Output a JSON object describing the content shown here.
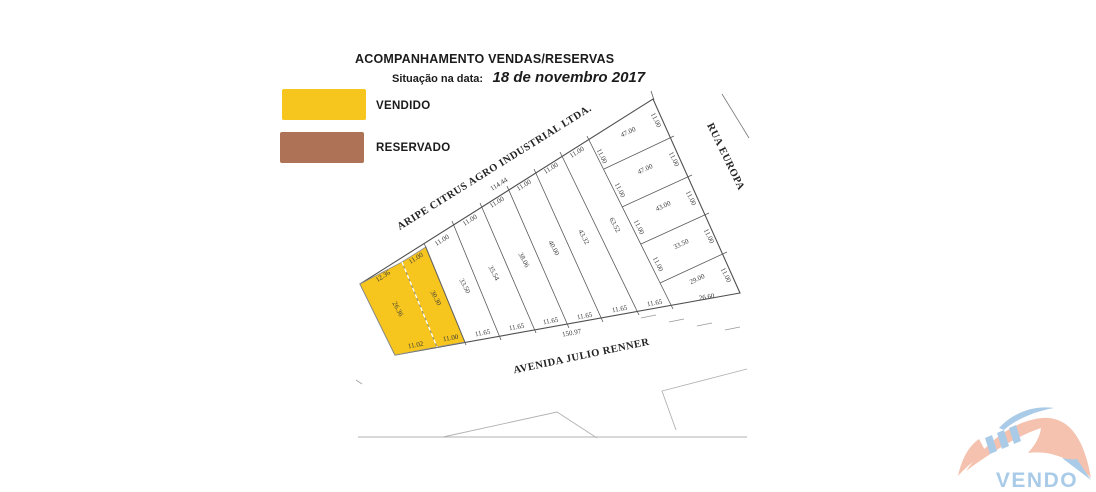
{
  "header": {
    "title": "ACOMPANHAMENTO VENDAS/RESERVAS",
    "situation_label": "Situação na data:",
    "situation_date": "18 de novembro 2017"
  },
  "legend": {
    "items": [
      {
        "label": "VENDIDO",
        "color": "#F6C51E"
      },
      {
        "label": "RESERVADO",
        "color": "#AE7257"
      }
    ]
  },
  "map": {
    "sold_color": "#F6C51E",
    "line_color": "#5a5a5a",
    "polygons": [
      {
        "name": "block-outline",
        "points": "360,284 653,99 740,293 395,355",
        "fill": "none",
        "stroke": "#4f4f4f",
        "w": 1.1
      },
      {
        "name": "sold-lot",
        "points": "360,284 402,262 437,347 395,355",
        "fill": "#F6C51E",
        "stroke": "#8c8c8c",
        "w": 0.8
      },
      {
        "name": "sold-lot",
        "points": "402,262 426,247 465,342 437,347",
        "fill": "#F6C51E",
        "stroke": "#8c8c8c",
        "w": 0.8
      }
    ],
    "lines": [
      {
        "name": "sold-lot-divider",
        "x1": 402,
        "y1": 262,
        "x2": 437,
        "y2": 347,
        "c": "#ffffff",
        "w": 1.3,
        "dash": "4 3"
      },
      {
        "name": "lot-line",
        "x1": 424,
        "y1": 243,
        "x2": 466,
        "y2": 345,
        "c": "#5a5a5a",
        "w": 0.8
      },
      {
        "name": "lot-line",
        "x1": 452,
        "y1": 221,
        "x2": 501,
        "y2": 340,
        "c": "#5a5a5a",
        "w": 0.8
      },
      {
        "name": "lot-line",
        "x1": 480,
        "y1": 203,
        "x2": 536,
        "y2": 333,
        "c": "#5a5a5a",
        "w": 0.8
      },
      {
        "name": "lot-line",
        "x1": 507,
        "y1": 186,
        "x2": 569,
        "y2": 328,
        "c": "#5a5a5a",
        "w": 0.8
      },
      {
        "name": "lot-line",
        "x1": 534,
        "y1": 169,
        "x2": 603,
        "y2": 322,
        "c": "#5a5a5a",
        "w": 0.8
      },
      {
        "name": "lot-line",
        "x1": 560,
        "y1": 152,
        "x2": 639,
        "y2": 315,
        "c": "#5a5a5a",
        "w": 0.8
      },
      {
        "name": "lot-line",
        "x1": 587,
        "y1": 136,
        "x2": 673,
        "y2": 309,
        "c": "#5a5a5a",
        "w": 0.8
      },
      {
        "name": "lot-line",
        "x1": 604,
        "y1": 169,
        "x2": 674,
        "y2": 136,
        "c": "#5a5a5a",
        "w": 0.8
      },
      {
        "name": "lot-line",
        "x1": 622,
        "y1": 207,
        "x2": 692,
        "y2": 175,
        "c": "#5a5a5a",
        "w": 0.8
      },
      {
        "name": "lot-line",
        "x1": 641,
        "y1": 244,
        "x2": 709,
        "y2": 213,
        "c": "#5a5a5a",
        "w": 0.8
      },
      {
        "name": "lot-line",
        "x1": 660,
        "y1": 283,
        "x2": 727,
        "y2": 252,
        "c": "#5a5a5a",
        "w": 0.8
      },
      {
        "name": "apex-tick",
        "x1": 651,
        "y1": 91,
        "x2": 654,
        "y2": 100,
        "c": "#5a5a5a",
        "w": 0.8
      },
      {
        "name": "street-edge",
        "x1": 722,
        "y1": 94,
        "x2": 749,
        "y2": 138,
        "c": "#777777",
        "w": 0.8
      },
      {
        "name": "road-dash",
        "x1": 641,
        "y1": 318,
        "x2": 656,
        "y2": 315,
        "c": "#9a9a9a",
        "w": 0.8
      },
      {
        "name": "road-dash",
        "x1": 669,
        "y1": 322,
        "x2": 684,
        "y2": 319,
        "c": "#9a9a9a",
        "w": 0.8
      },
      {
        "name": "road-dash",
        "x1": 697,
        "y1": 326,
        "x2": 712,
        "y2": 323,
        "c": "#9a9a9a",
        "w": 0.8
      },
      {
        "name": "road-dash",
        "x1": 725,
        "y1": 330,
        "x2": 740,
        "y2": 327,
        "c": "#9a9a9a",
        "w": 0.8
      },
      {
        "name": "ground-mark",
        "x1": 356,
        "y1": 380,
        "x2": 362,
        "y2": 384,
        "c": "#a8a8a8",
        "w": 1
      }
    ],
    "polylines": [
      {
        "name": "ground-line",
        "points": "358,437 747,437",
        "c": "#b2b2b2",
        "w": 1.1
      },
      {
        "name": "ground-line",
        "points": "443,437 557,412 597,438",
        "c": "#b2b2b2",
        "w": 0.9
      },
      {
        "name": "ground-line",
        "points": "747,369 662,391 676,430",
        "c": "#b2b2b2",
        "w": 0.9
      }
    ],
    "labels": [
      {
        "name": "street-label",
        "t": "ARIPE CITRUS AGRO INDUSTRIAL LTDA.",
        "x": 496,
        "y": 170,
        "r": -32,
        "s": 10.5,
        "b": true,
        "c": "#222222",
        "ls": 0.5
      },
      {
        "name": "street-label",
        "t": "RUA EUROPA",
        "x": 723,
        "y": 158,
        "r": 64,
        "s": 10.5,
        "b": true,
        "c": "#222222",
        "ls": 0.5
      },
      {
        "name": "street-label",
        "t": "AVENIDA JULIO RENNER",
        "x": 582,
        "y": 359,
        "r": -12,
        "s": 10.5,
        "b": true,
        "c": "#222222",
        "ls": 0.5
      },
      {
        "t": "114.44",
        "x": 500,
        "y": 186,
        "r": -32
      },
      {
        "t": "12.36",
        "x": 384,
        "y": 278,
        "r": -32
      },
      {
        "t": "11.00",
        "x": 417,
        "y": 260,
        "r": -32
      },
      {
        "t": "11.00",
        "x": 443,
        "y": 242,
        "r": -32
      },
      {
        "t": "11.00",
        "x": 471,
        "y": 222,
        "r": -32
      },
      {
        "t": "11.00",
        "x": 498,
        "y": 204,
        "r": -32
      },
      {
        "t": "11.00",
        "x": 525,
        "y": 187,
        "r": -32
      },
      {
        "t": "11.00",
        "x": 552,
        "y": 170,
        "r": -32
      },
      {
        "t": "11.00",
        "x": 578,
        "y": 154,
        "r": -32
      },
      {
        "t": "11.00",
        "x": 654,
        "y": 121,
        "r": 64
      },
      {
        "t": "11.00",
        "x": 672,
        "y": 160,
        "r": 64
      },
      {
        "t": "11.00",
        "x": 689,
        "y": 199,
        "r": 64
      },
      {
        "t": "11.00",
        "x": 707,
        "y": 237,
        "r": 64
      },
      {
        "t": "11.00",
        "x": 724,
        "y": 276,
        "r": 64
      },
      {
        "t": "11.00",
        "x": 600,
        "y": 157,
        "r": 64
      },
      {
        "t": "11.00",
        "x": 618,
        "y": 191,
        "r": 64
      },
      {
        "t": "11.00",
        "x": 637,
        "y": 228,
        "r": 64
      },
      {
        "t": "11.00",
        "x": 656,
        "y": 265,
        "r": 64
      },
      {
        "t": "26.36",
        "x": 396,
        "y": 310,
        "r": 62
      },
      {
        "t": "30.30",
        "x": 434,
        "y": 299,
        "r": 62
      },
      {
        "t": "33.50",
        "x": 463,
        "y": 287,
        "r": 62
      },
      {
        "t": "35.54",
        "x": 492,
        "y": 274,
        "r": 62
      },
      {
        "t": "38.06",
        "x": 522,
        "y": 261,
        "r": 62
      },
      {
        "t": "40.00",
        "x": 552,
        "y": 249,
        "r": 62
      },
      {
        "t": "43.32",
        "x": 582,
        "y": 238,
        "r": 62
      },
      {
        "t": "63.52",
        "x": 613,
        "y": 226,
        "r": 62
      },
      {
        "t": "47.00",
        "x": 629,
        "y": 134,
        "r": -25
      },
      {
        "t": "47.00",
        "x": 646,
        "y": 171,
        "r": -25
      },
      {
        "t": "43.00",
        "x": 664,
        "y": 208,
        "r": -25
      },
      {
        "t": "33.50",
        "x": 682,
        "y": 246,
        "r": -25
      },
      {
        "t": "29.00",
        "x": 698,
        "y": 281,
        "r": -25
      },
      {
        "t": "26.60",
        "x": 707,
        "y": 299,
        "r": -10
      },
      {
        "t": "11.02",
        "x": 416,
        "y": 347,
        "r": -10
      },
      {
        "t": "11.00",
        "x": 451,
        "y": 340,
        "r": -10
      },
      {
        "t": "11.65",
        "x": 483,
        "y": 335,
        "r": -10
      },
      {
        "t": "11.65",
        "x": 517,
        "y": 329,
        "r": -10
      },
      {
        "t": "11.65",
        "x": 551,
        "y": 323,
        "r": -10
      },
      {
        "t": "11.65",
        "x": 585,
        "y": 318,
        "r": -10
      },
      {
        "t": "11.65",
        "x": 620,
        "y": 311,
        "r": -10
      },
      {
        "t": "11.65",
        "x": 655,
        "y": 305,
        "r": -10
      },
      {
        "t": "150.97",
        "x": 572,
        "y": 335,
        "r": -10
      }
    ]
  },
  "logo": {
    "salmon": "#F4C2AE",
    "blue": "#A9CBE8",
    "shapes": [
      {
        "name": "logo-roof-left",
        "path": "M 958 476 C 962 458 969 446 979 439 L 986 452 C 976 459 966 467 958 476 Z",
        "fill": "#F4C2AE"
      },
      {
        "name": "logo-roof-main",
        "path": "M 966 471 C 988 440 1014 421 1042 418 C 1068 416 1084 437 1091 478 C 1073 459 1051 450 1028 453 C 1035 445 1040 437 1041 428 C 1017 436 992 452 966 471 Z",
        "fill": "#F4C2AE"
      },
      {
        "name": "logo-swoosh",
        "path": "M 999 428 C 1013 413 1033 405 1054 408 C 1036 411 1016 419 1004 430 Z",
        "fill": "#A9CBE8"
      },
      {
        "name": "logo-kick",
        "path": "M 1062 458 L 1091 480 L 1077 459 C 1072 460 1067 459 1062 458 Z",
        "fill": "#A9CBE8"
      },
      {
        "name": "logo-window",
        "path": "M 985 438 L 992 435 L 997 451 L 990 454 Z",
        "fill": "#A9CBE8"
      },
      {
        "name": "logo-window",
        "path": "M 997 433 L 1004 430 L 1009 446 L 1002 449 Z",
        "fill": "#A9CBE8"
      },
      {
        "name": "logo-window",
        "path": "M 1009 428 L 1016 425 L 1021 441 L 1014 444 Z",
        "fill": "#A9CBE8"
      }
    ],
    "wordmark": {
      "t": "VENDO",
      "x": 1037,
      "y": 487,
      "s": 21,
      "c": "#A9CBE8"
    }
  }
}
